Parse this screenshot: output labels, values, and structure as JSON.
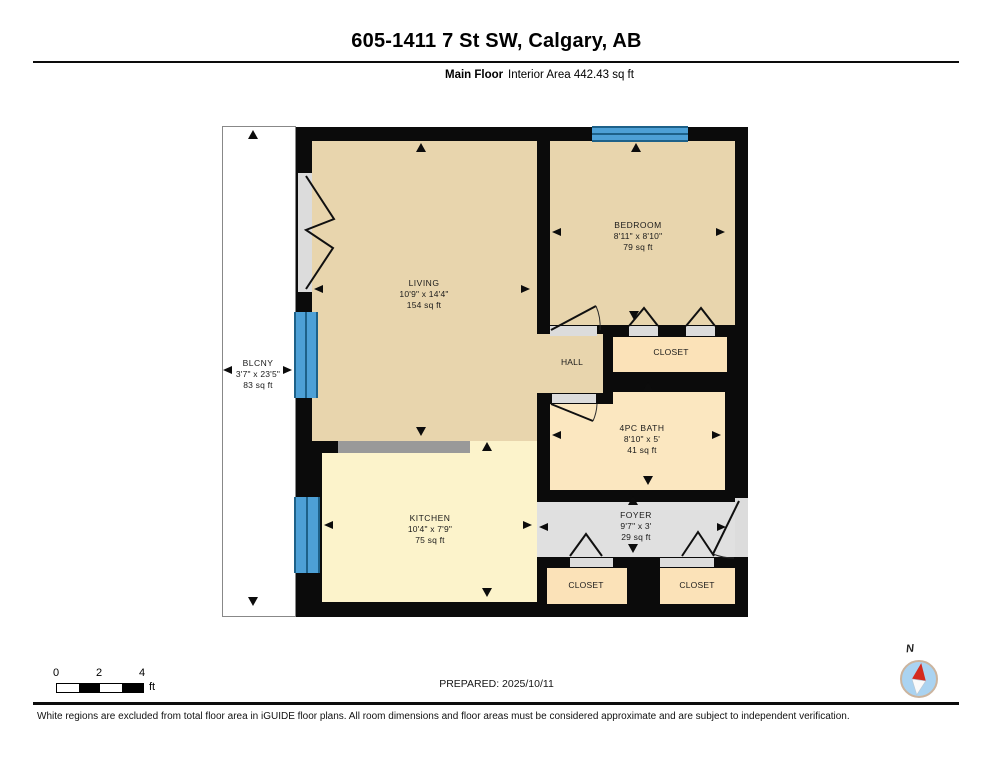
{
  "header": {
    "title": "605-1411 7 St SW, Calgary, AB",
    "floor_label": "Main Floor",
    "area_label": "Interior Area 442.43 sq ft"
  },
  "floorplan": {
    "rooms": {
      "living": {
        "name": "LIVING",
        "dims": "10'9\" x 14'4\"",
        "area": "154 sq ft"
      },
      "bedroom": {
        "name": "BEDROOM",
        "dims": "8'11\" x 8'10\"",
        "area": "79 sq ft"
      },
      "bath": {
        "name": "4PC BATH",
        "dims": "8'10\" x 5'",
        "area": "41 sq ft"
      },
      "kitchen": {
        "name": "KITCHEN",
        "dims": "10'4\" x 7'9\"",
        "area": "75 sq ft"
      },
      "foyer": {
        "name": "FOYER",
        "dims": "9'7\" x 3'",
        "area": "29 sq ft"
      },
      "balcony": {
        "name": "BLCNY",
        "dims": "3'7\" x 23'5\"",
        "area": "83 sq ft"
      },
      "hall": {
        "name": "HALL"
      },
      "closet_bedroom": {
        "name": "CLOSET"
      },
      "closet_foyer_left": {
        "name": "CLOSET"
      },
      "closet_foyer_right": {
        "name": "CLOSET"
      }
    },
    "colors": {
      "wall": "#0b0b0b",
      "room_tan": "#e8d5ad",
      "room_yellow": "#fcf3cb",
      "room_cream": "#fbe7c0",
      "room_peach": "#fbe2b8",
      "floor_gray": "#e0e0e0",
      "window_blue": "#4da0d6",
      "window_line": "#1d6189",
      "counter_gray": "#999999",
      "balcony_border": "#888888"
    }
  },
  "scale_bar": {
    "ticks": [
      "0",
      "2",
      "4"
    ],
    "unit": "ft"
  },
  "compass": {
    "north_label": "N",
    "needle_color": "#d42a1e"
  },
  "footer": {
    "prepared": "PREPARED: 2025/10/11",
    "disclaimer": "White regions are excluded from total floor area in iGUIDE floor plans. All room dimensions and floor areas must be considered approximate and are subject to independent verification."
  }
}
